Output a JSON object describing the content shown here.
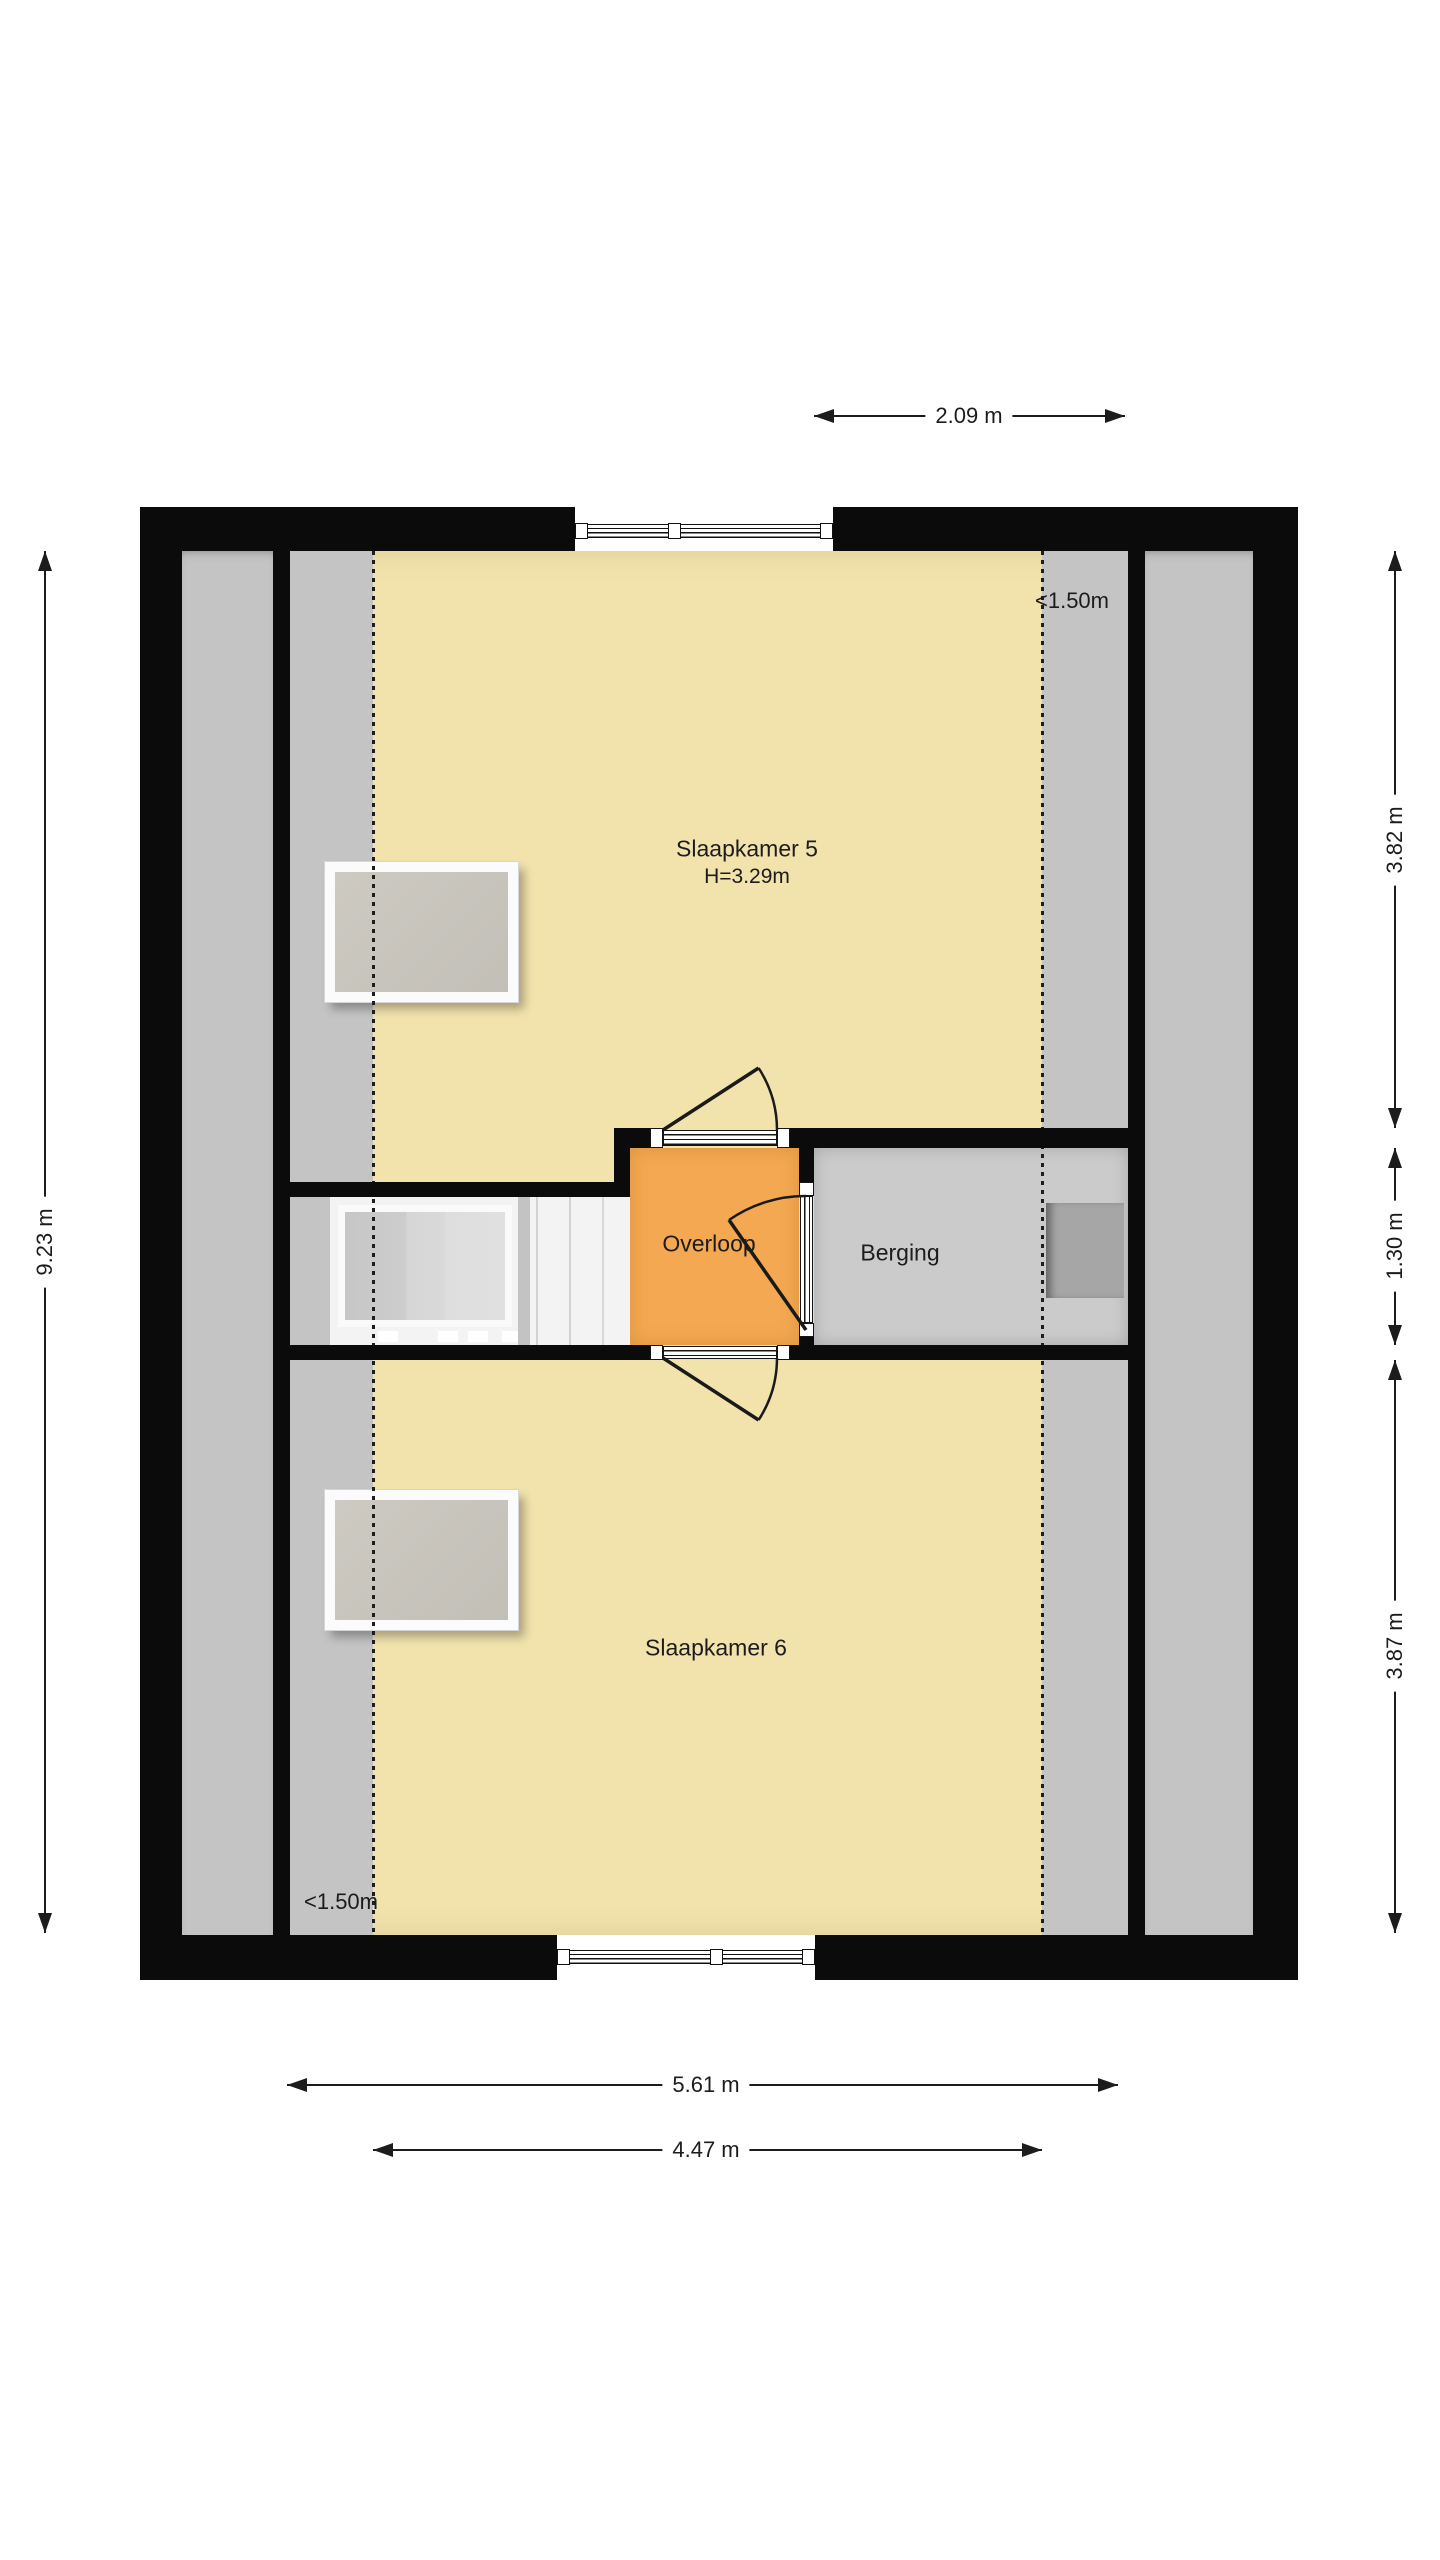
{
  "theme": {
    "floor_yellow": "#F2E3AD",
    "landing_orange": "#F3A851",
    "under_roof_grey": "#C4C4C4",
    "storage_grey": "#CBCBCB",
    "wall_black": "#0B0B0B",
    "chimney_grey": "#A6A6A6",
    "line_dark": "#1C1C1C"
  },
  "rooms": {
    "slaapkamer5": {
      "label": "Slaapkamer 5",
      "height_label": "H=3.29m"
    },
    "slaapkamer6": {
      "label": "Slaapkamer 6"
    },
    "overloop": {
      "label": "Overloop"
    },
    "berging": {
      "label": "Berging"
    }
  },
  "annotations": {
    "headroom_top": "<1.50m",
    "headroom_bottom": "<1.50m"
  },
  "dimensions": {
    "top": {
      "label": "2.09 m"
    },
    "left": {
      "label": "9.23 m"
    },
    "right_top": {
      "label": "3.82 m"
    },
    "right_middle": {
      "label": "1.30 m"
    },
    "right_bottom": {
      "label": "3.87 m"
    },
    "bottom_outer": {
      "label": "5.61 m"
    },
    "bottom_inner": {
      "label": "4.47 m"
    }
  }
}
